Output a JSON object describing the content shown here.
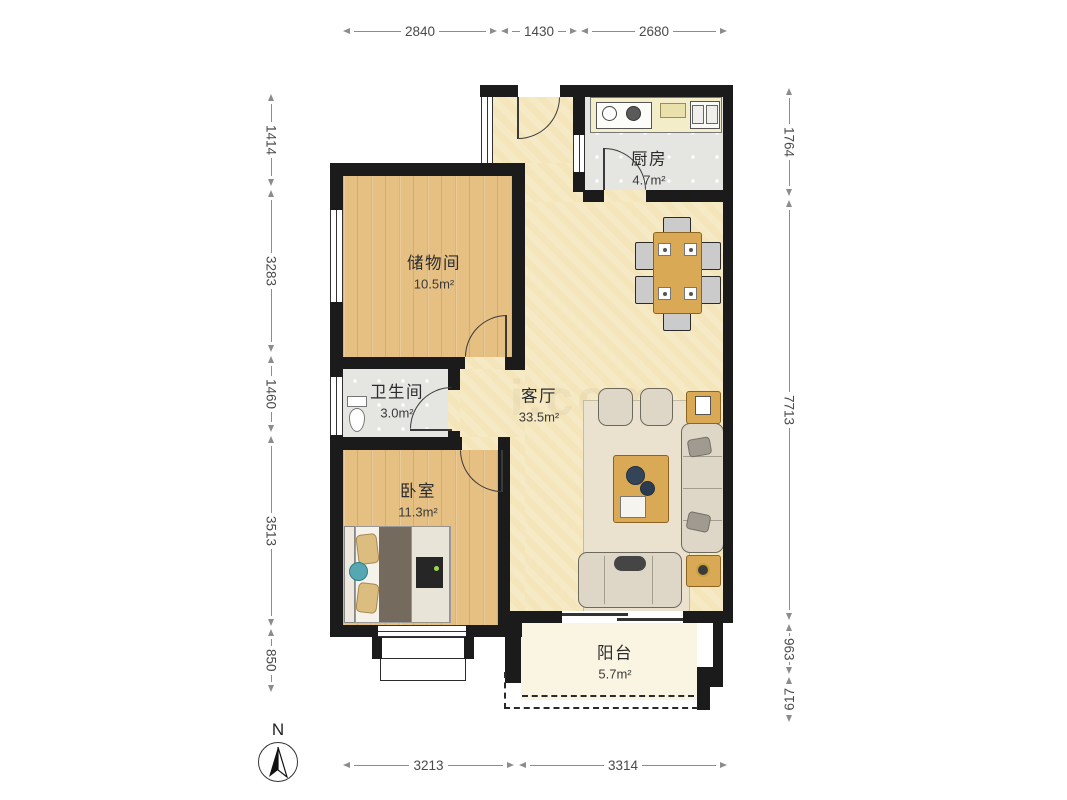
{
  "rooms": {
    "kitchen": {
      "name": "厨房",
      "area": "4.7m²"
    },
    "storage": {
      "name": "储物间",
      "area": "10.5m²"
    },
    "bathroom": {
      "name": "卫生间",
      "area": "3.0m²"
    },
    "living": {
      "name": "客厅",
      "area": "33.5m²"
    },
    "bedroom": {
      "name": "卧室",
      "area": "11.3m²"
    },
    "balcony": {
      "name": "阳台",
      "area": "5.7m²"
    }
  },
  "dims": {
    "top": [
      "2840",
      "1430",
      "2680"
    ],
    "bottom": [
      "3213",
      "3314"
    ],
    "left": [
      "1414",
      "3283",
      "1460",
      "3513",
      "850"
    ],
    "right": [
      "1764",
      "7713",
      "963",
      "617"
    ]
  },
  "compass": {
    "north": "N"
  },
  "watermark": {
    "text": "i.com"
  },
  "colors": {
    "wall": "#1b1b1b",
    "wood_floor": "#e6c083",
    "living_floor": "#f5e7bd",
    "tile_floor": "#e5e5e2",
    "balcony_floor": "#faf5e3",
    "furniture_wood": "#d9a955",
    "sofa": "#ded7c8",
    "dimension_text": "#4a4a4a"
  }
}
